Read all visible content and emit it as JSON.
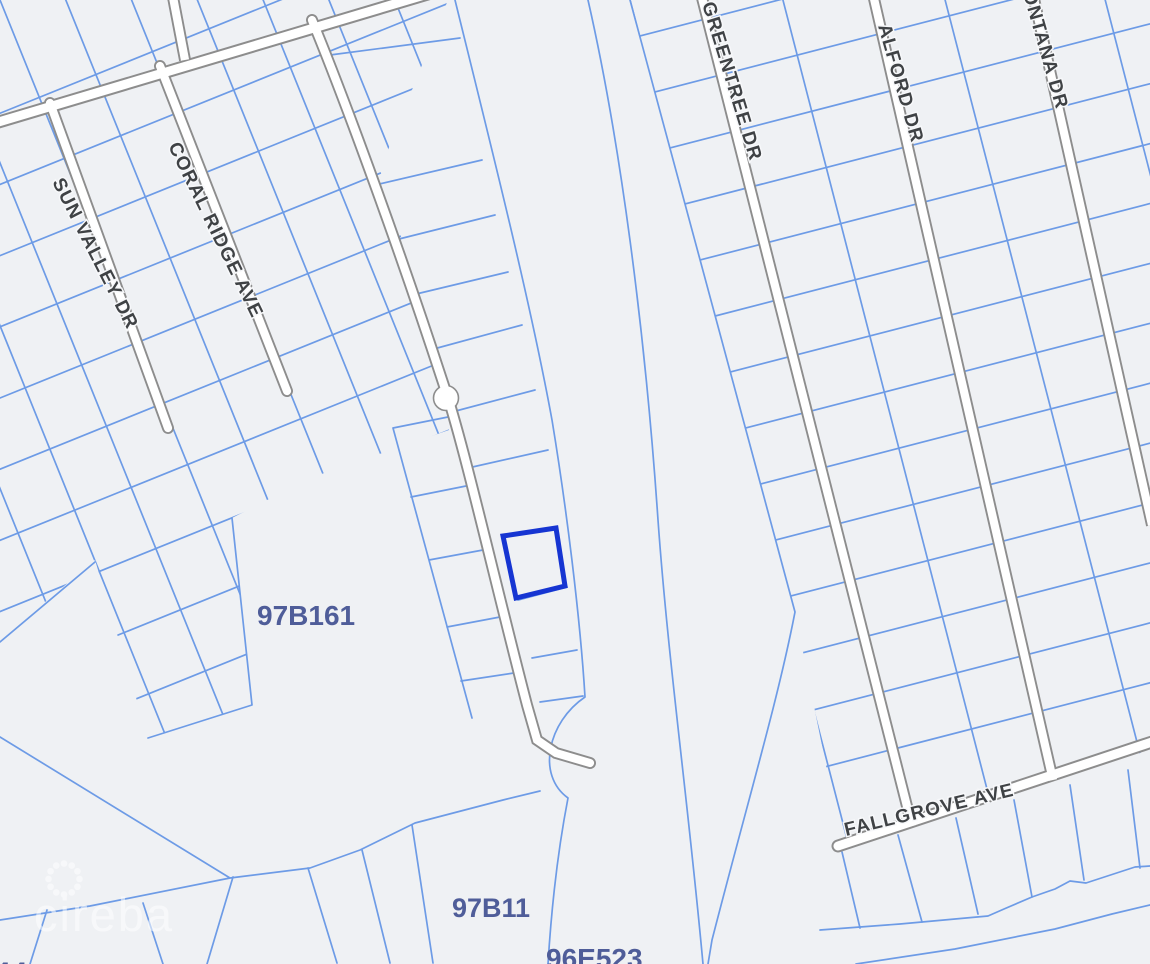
{
  "map": {
    "streets": [
      {
        "id": "sun-valley-dr",
        "name": "SUN VALLEY DR"
      },
      {
        "id": "coral-ridge-ave",
        "name": "CORAL RIDGE AVE"
      },
      {
        "id": "greentree-dr",
        "name": "GREENTREE DR"
      },
      {
        "id": "alford-dr",
        "name": "ALFORD DR"
      },
      {
        "id": "montana-dr",
        "name": "MONTANA DR"
      },
      {
        "id": "fallgrove-ave",
        "name": "FALLGROVE AVE"
      }
    ],
    "blocks": [
      {
        "label": "97B161"
      },
      {
        "label": "97B11"
      },
      {
        "label": "96E523"
      },
      {
        "label": "97B8"
      },
      {
        "label": "44"
      }
    ],
    "selected_parcel": {
      "status": "highlighted",
      "outline_color": "#1635d2"
    },
    "watermark": {
      "text": "cireba",
      "logo": "dotted-spinner-logo"
    },
    "colors": {
      "background": "#eff1f4",
      "parcel_line": "#6d9be6",
      "road_fill": "#ffffff",
      "road_casing": "#8d8d8d",
      "street_label": "#3f4245",
      "block_label": "#4f5d99",
      "highlight": "#1635d2"
    }
  }
}
